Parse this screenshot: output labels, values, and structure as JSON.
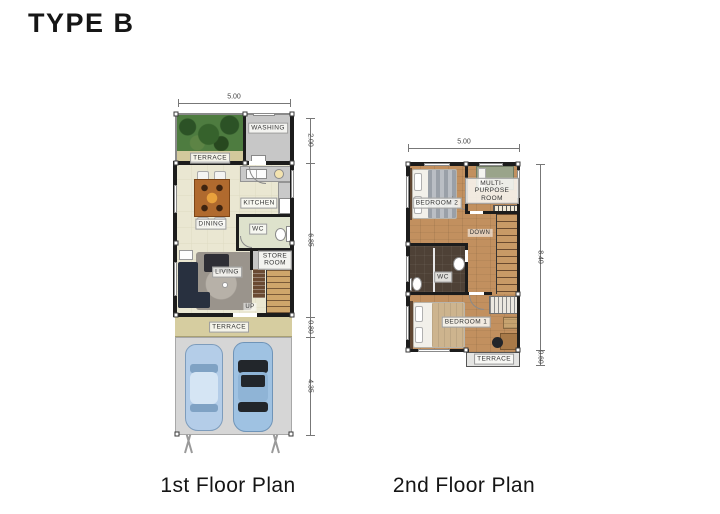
{
  "title": "TYPE B",
  "floor1": {
    "caption": "1st Floor Plan",
    "dim_top": "5.00",
    "dim_right": [
      "2.00",
      "6.85",
      "0.80",
      "4.35"
    ],
    "labels": {
      "terrace_top": "TERRACE",
      "washing": "WASHING",
      "dining": "DINING",
      "kitchen": "KITCHEN",
      "wc": "WC",
      "store_room": "STORE ROOM",
      "living": "LIVING",
      "up": "UP",
      "terrace": "TERRACE"
    }
  },
  "floor2": {
    "caption": "2nd Floor Plan",
    "dim_top": "5.00",
    "dim_right": [
      "8.40",
      "0.60"
    ],
    "labels": {
      "bedroom2": "BEDROOM 2",
      "multipurpose": "MULTI-PURPOSE ROOM",
      "down": "DOWN",
      "wc": "WC",
      "bedroom1": "BEDROOM 1",
      "terrace": "TERRACE"
    }
  },
  "colors": {
    "wall": "#1c1c1c",
    "floor_cream": "#eae7d2",
    "terrace_tan": "#d2c99c",
    "garden_green": "#4e7c40",
    "room_grey": "#c7c7c7",
    "carport_grey": "#d6d6d6",
    "car_blue": "#aecbe7",
    "wood_brown": "#c2905f",
    "wc_dark": "#4e4136",
    "wc_sage": "#dee2cc"
  }
}
